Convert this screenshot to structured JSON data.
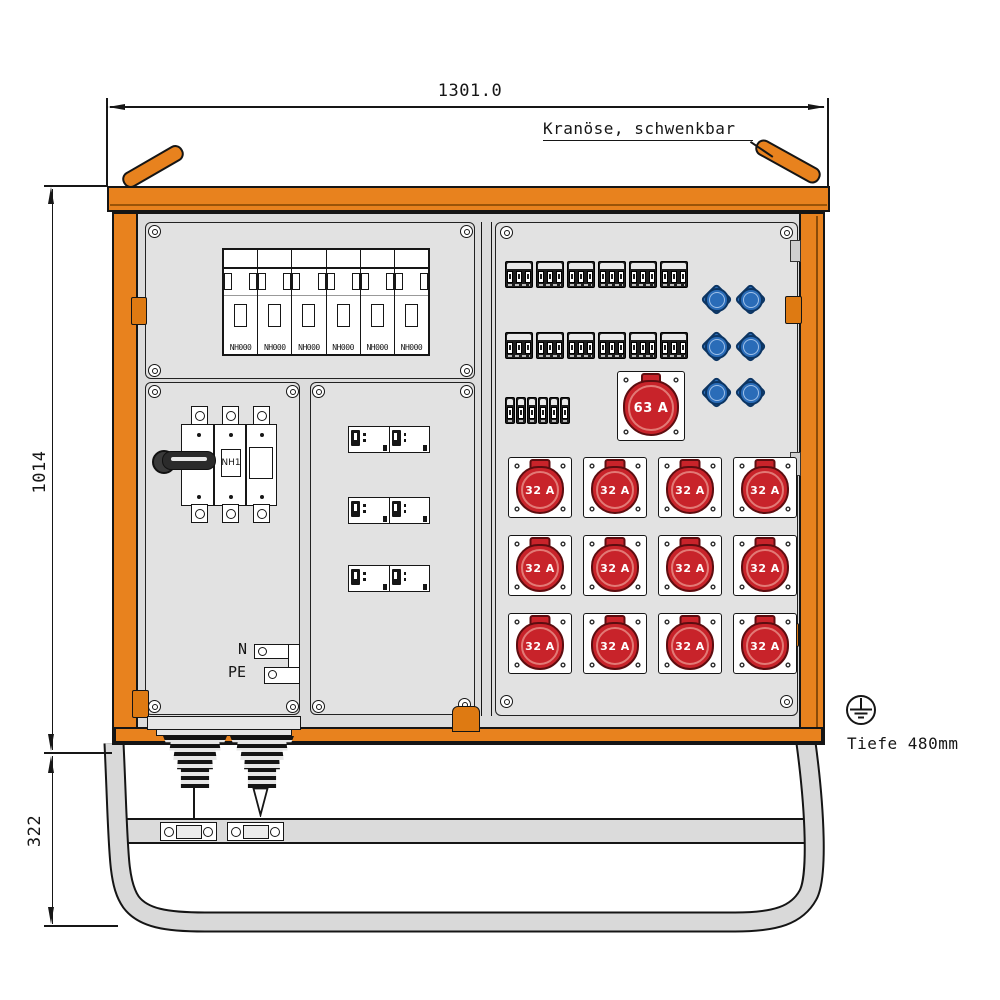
{
  "annotations": {
    "width_dim": "1301.0",
    "height_dim": "1014",
    "base_dim": "322",
    "crane_note": "Kranöse, schwenkbar",
    "depth_note": "Tiefe 480mm"
  },
  "colors": {
    "frame_orange": "#E8821E",
    "panel_gray": "#DCDCDC",
    "cee_red": "#C8232A",
    "schuko_blue": "#2A6CB8",
    "line_dark": "#161616"
  },
  "left_panel": {
    "fuse_labels": [
      "NH000",
      "NH000",
      "NH000",
      "NH000",
      "NH000",
      "NH000"
    ],
    "main_switch_label": "NH1",
    "neutral_label": "N",
    "earth_label": "PE"
  },
  "right_panel": {
    "socket_63a_label": "63 A",
    "socket_32a_labels": [
      "32 A",
      "32 A",
      "32 A",
      "32 A",
      "32 A",
      "32 A",
      "32 A",
      "32 A",
      "32 A",
      "32 A",
      "32 A",
      "32 A"
    ]
  }
}
